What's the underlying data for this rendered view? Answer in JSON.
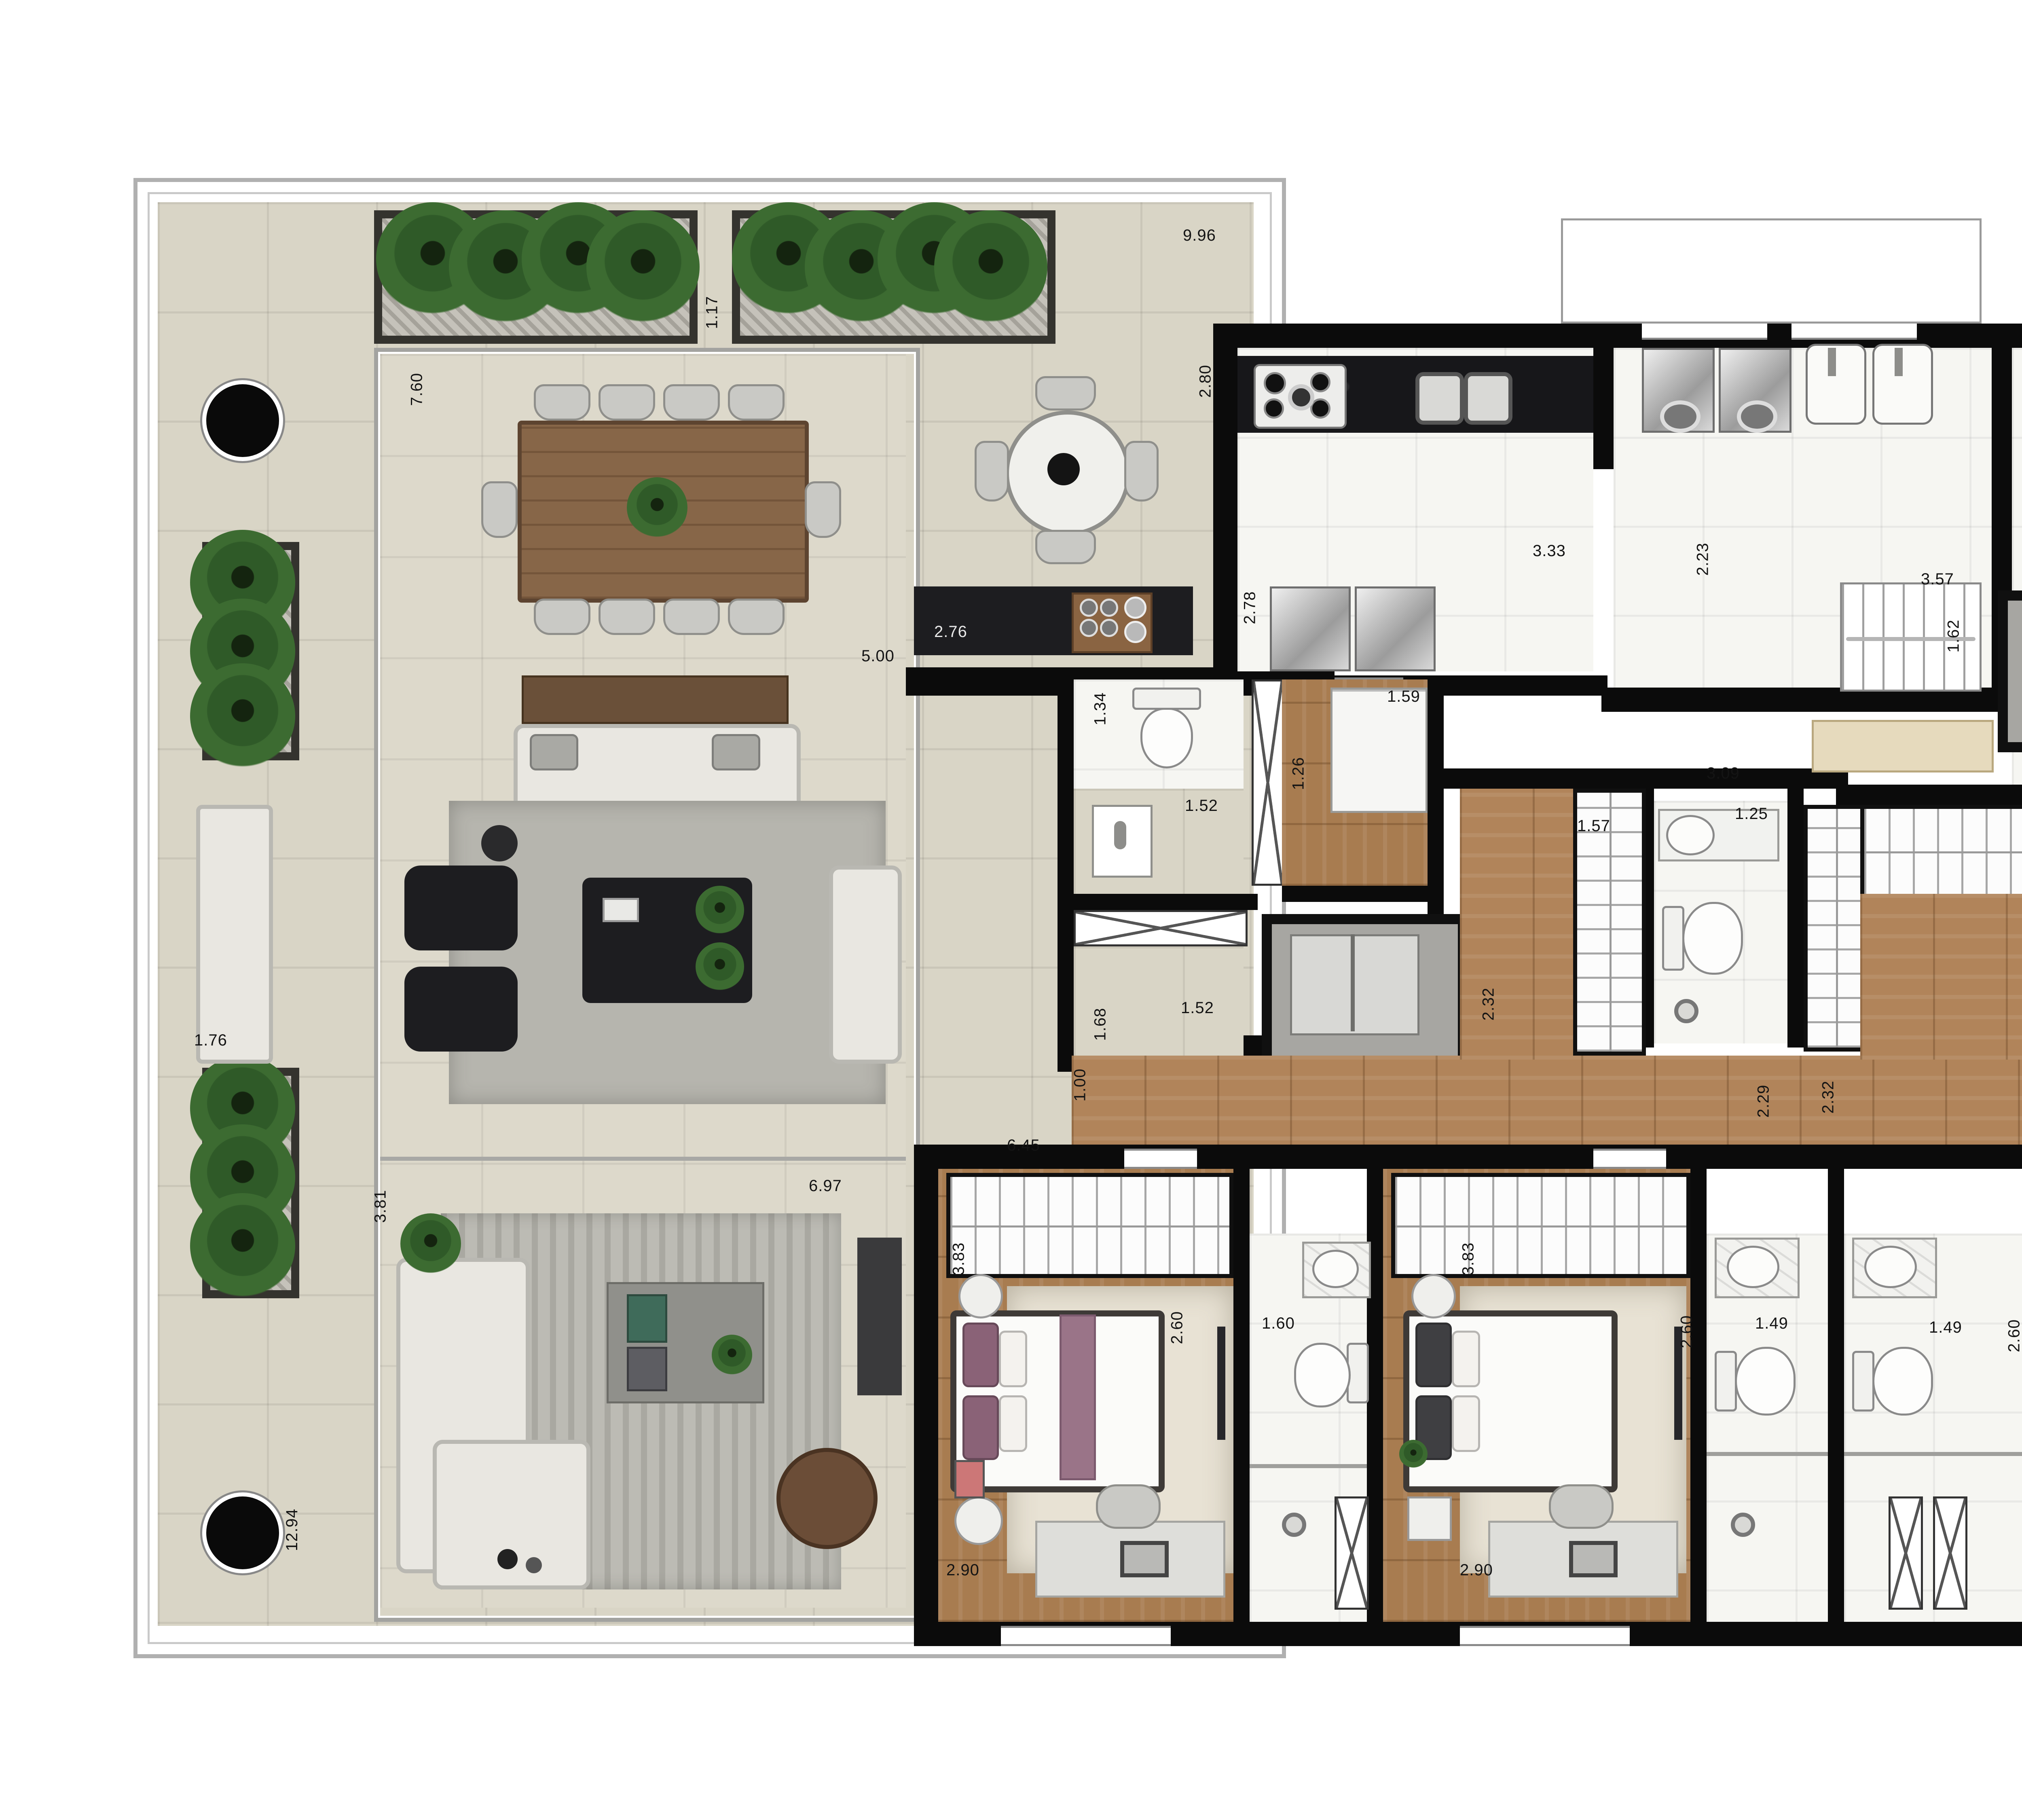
{
  "plan": {
    "type": "apartment-floor-plan",
    "units": "meters",
    "dims": [
      {
        "v": "9.96",
        "o": "h"
      },
      {
        "v": "1.17",
        "o": "v"
      },
      {
        "v": "7.60",
        "o": "v"
      },
      {
        "v": "2.80",
        "o": "v"
      },
      {
        "v": "5.00",
        "o": "h"
      },
      {
        "v": "2.76",
        "o": "h"
      },
      {
        "v": "2.78",
        "o": "v"
      },
      {
        "v": "1.34",
        "o": "v"
      },
      {
        "v": "1.59",
        "o": "h"
      },
      {
        "v": "1.26",
        "o": "v"
      },
      {
        "v": "1.52",
        "o": "h"
      },
      {
        "v": "1.52",
        "o": "h"
      },
      {
        "v": "3.33",
        "o": "h"
      },
      {
        "v": "2.23",
        "o": "v"
      },
      {
        "v": "3.57",
        "o": "h"
      },
      {
        "v": "1.62",
        "o": "v"
      },
      {
        "v": "3.09",
        "o": "h"
      },
      {
        "v": "1.57",
        "o": "h"
      },
      {
        "v": "1.25",
        "o": "h"
      },
      {
        "v": "2.32",
        "o": "v"
      },
      {
        "v": "2.29",
        "o": "v"
      },
      {
        "v": "2.32",
        "o": "v"
      },
      {
        "v": "4.88",
        "o": "h"
      },
      {
        "v": "2.29",
        "o": "v"
      },
      {
        "v": "3.02",
        "o": "h"
      },
      {
        "v": "1.68",
        "o": "v"
      },
      {
        "v": "1.00",
        "o": "v"
      },
      {
        "v": "6.45",
        "o": "h"
      },
      {
        "v": "6.97",
        "o": "h"
      },
      {
        "v": "1.76",
        "o": "h"
      },
      {
        "v": "3.81",
        "o": "v"
      },
      {
        "v": "12.94",
        "o": "v"
      },
      {
        "v": "3.83",
        "o": "v"
      },
      {
        "v": "2.60",
        "o": "v"
      },
      {
        "v": "1.60",
        "o": "h"
      },
      {
        "v": "2.90",
        "o": "h"
      },
      {
        "v": "3.83",
        "o": "v"
      },
      {
        "v": "2.90",
        "o": "h"
      },
      {
        "v": "2.60",
        "o": "v"
      },
      {
        "v": "1.49",
        "o": "h"
      },
      {
        "v": "1.49",
        "o": "h"
      },
      {
        "v": "2.60",
        "o": "v"
      },
      {
        "v": "3.83",
        "o": "v"
      },
      {
        "v": "2.90",
        "o": "h"
      },
      {
        "v": "4.95",
        "o": "v"
      },
      {
        "v": "1.65",
        "o": "h"
      },
      {
        "v": "3.94",
        "o": "h"
      },
      {
        "v": "4.99",
        "o": "v"
      }
    ],
    "colors": {
      "wall": "#0b0b0b",
      "terrace_tile": "#d9d5c6",
      "white_tile": "#f6f6f2",
      "wood_floor": "#b1845a",
      "concrete": "#c9c6bf",
      "plant_green": "#2f5a28",
      "counter_black": "#1d1d20"
    }
  }
}
